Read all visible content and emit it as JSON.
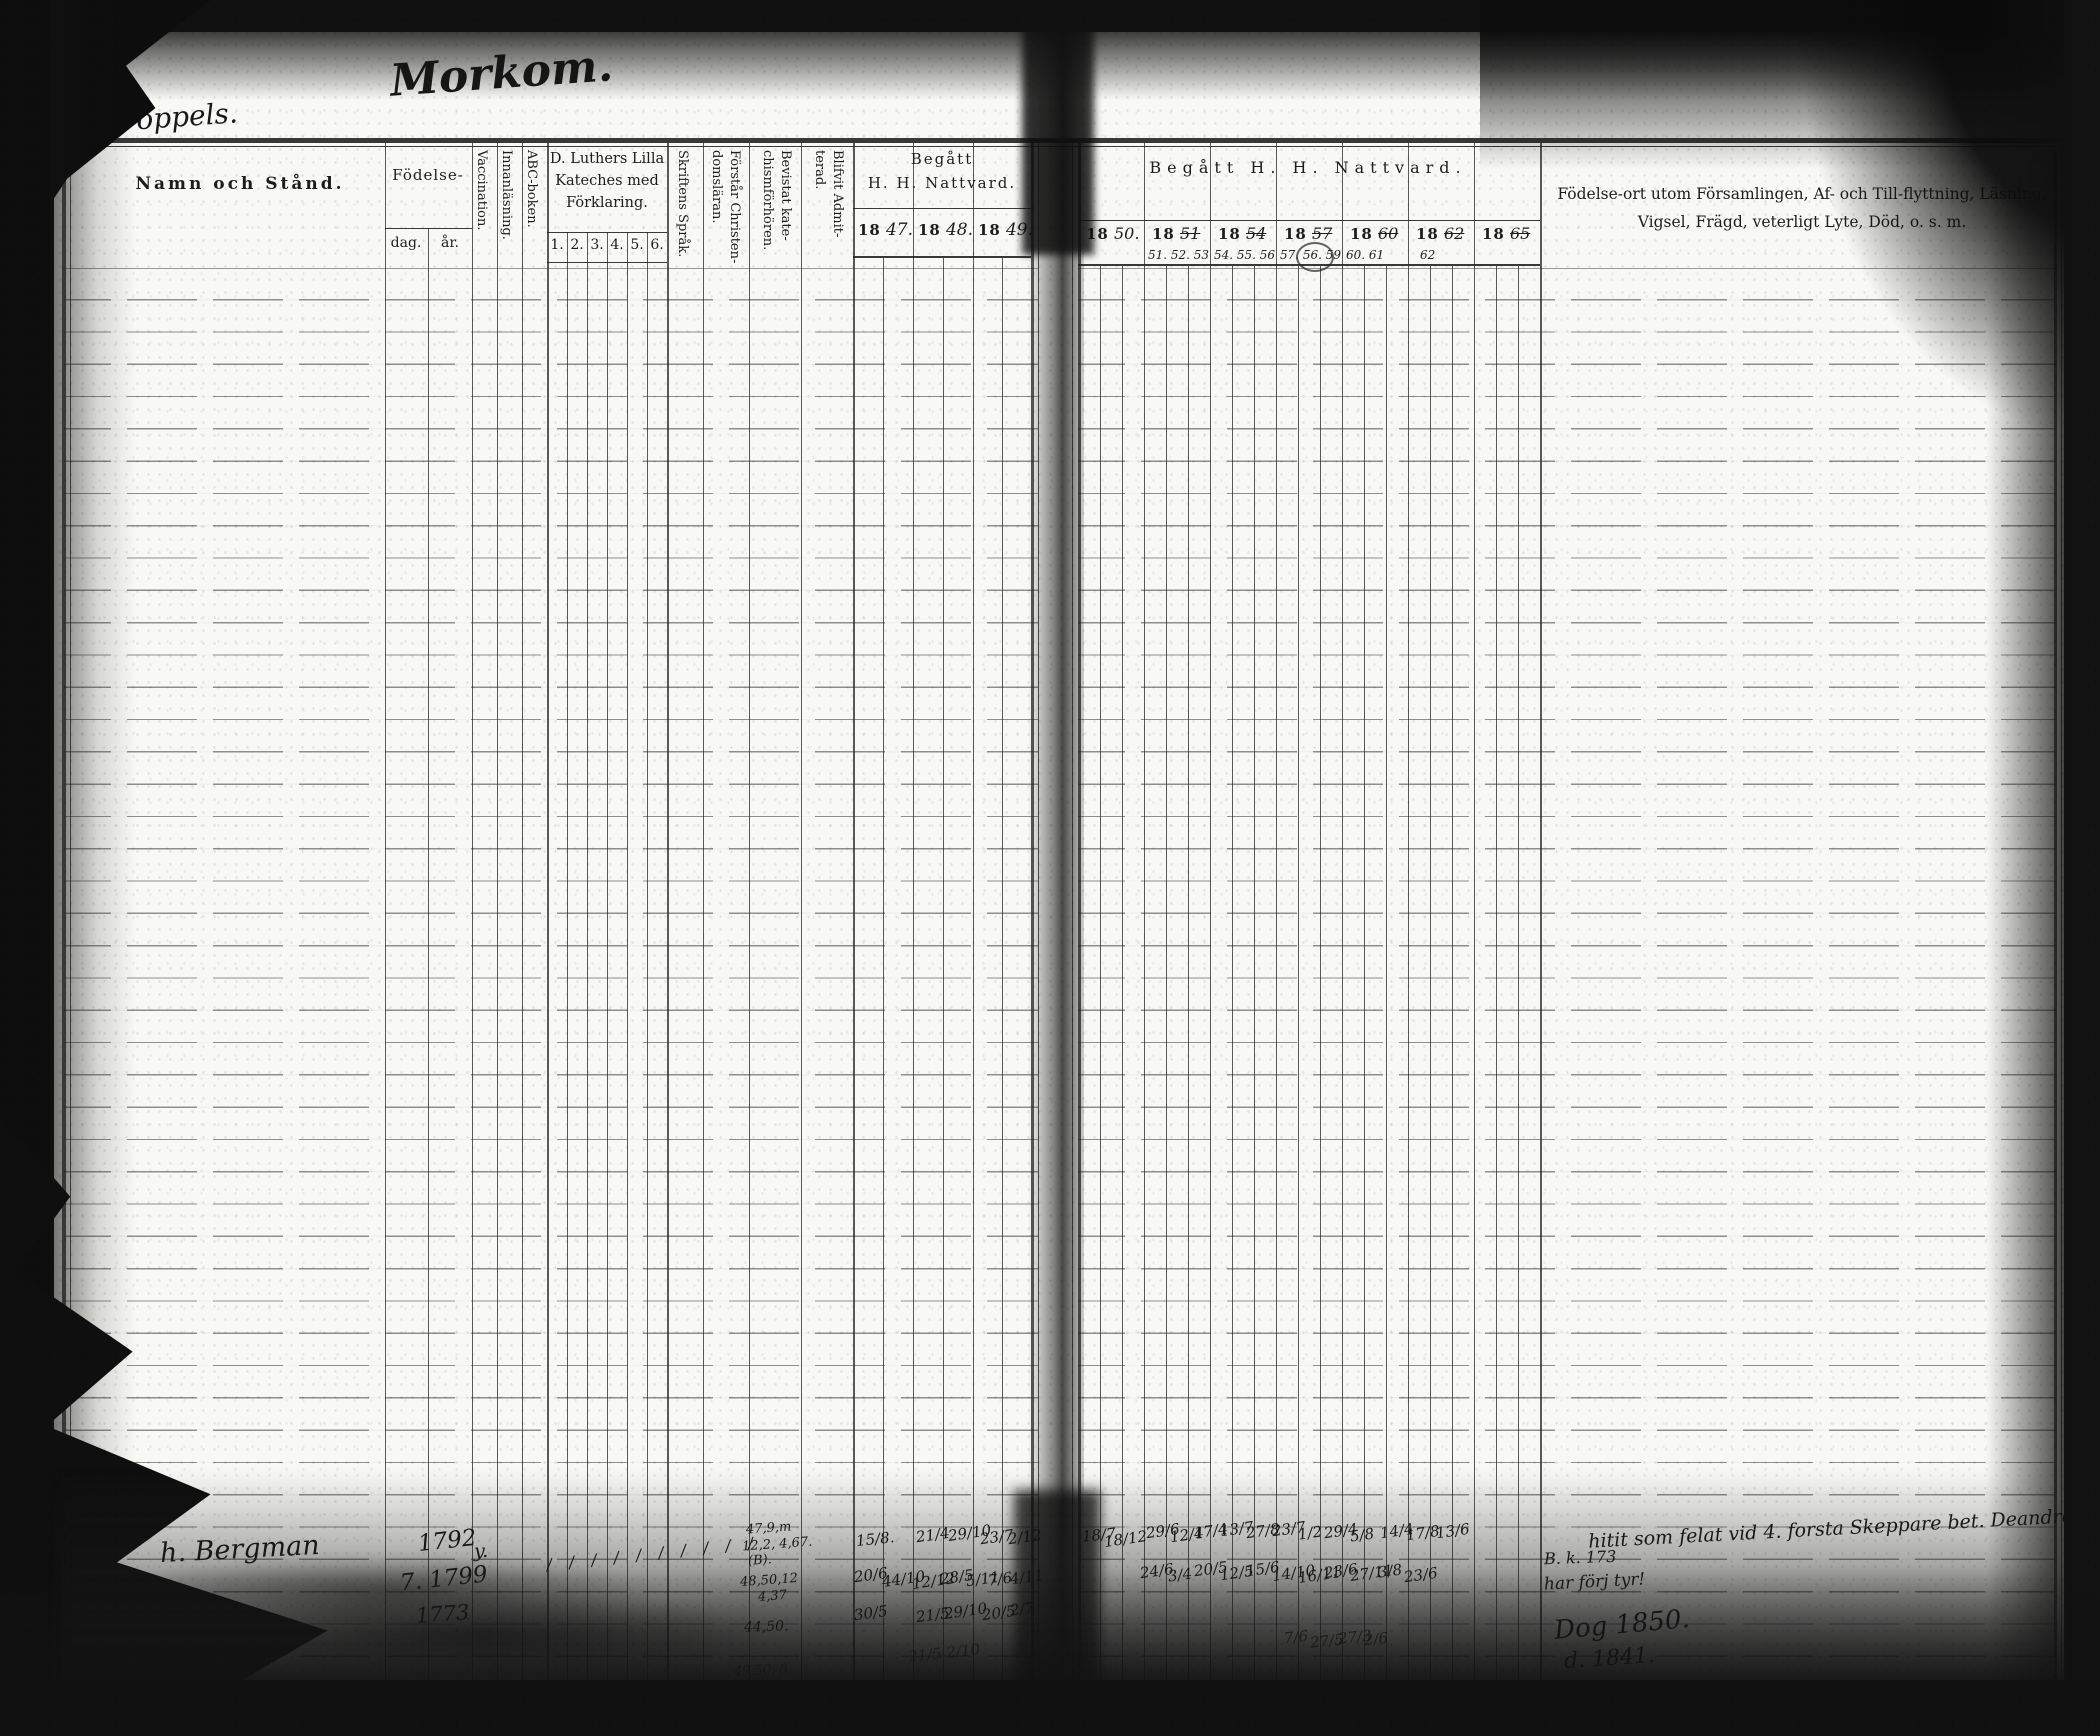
{
  "scan": {
    "description": "Scanned two-page spread of a 19th-century Swedish parish communion ledger"
  },
  "left_page": {
    "name_header": "Namn och Stånd.",
    "birth_label": "Födelse-",
    "birth_day": "dag.",
    "birth_year": "år.",
    "col_vaccination": "Vaccination.",
    "col_reading": "Innanläsning.",
    "col_abc": "ABC-boken.",
    "catechism_line1": "D. Luthers Lilla",
    "catechism_line2": "Kateches med",
    "catechism_line3": "Förklaring.",
    "catechism_numbers": [
      "1.",
      "2.",
      "3.",
      "4.",
      "5.",
      "6."
    ],
    "col_scripture": "Skriftens Språk.",
    "col_understands_1": "Förstår Christen-",
    "col_understands_2": "domsläran.",
    "col_attended_1": "Bevistat kate-",
    "col_attended_2": "chismförhören.",
    "col_admitted_1": "Blifvit Admit-",
    "col_admitted_2": "terad.",
    "communion_line1": "Begått",
    "communion_line2": "H. H. Nattvard.",
    "years": [
      {
        "printed": "18",
        "hand": "47."
      },
      {
        "printed": "18",
        "hand": "48."
      },
      {
        "printed": "18",
        "hand": "49."
      }
    ]
  },
  "right_page": {
    "communion_label": "Begått  H.  H.  Nattvard.",
    "years": [
      {
        "printed": "18",
        "hand": "50.",
        "list": ""
      },
      {
        "printed": "18",
        "hand": "51",
        "list": "51. 52. 53"
      },
      {
        "printed": "18",
        "hand": "54",
        "list": "54. 55. 56"
      },
      {
        "printed": "18",
        "hand": "57",
        "list": "57. 56. 59"
      },
      {
        "printed": "18",
        "hand": "60",
        "list": "60. 61"
      },
      {
        "printed": "18",
        "hand": "62",
        "list": "62"
      },
      {
        "printed": "18",
        "hand": "65",
        "list": ""
      }
    ],
    "notes_line1": "Födelse-ort utom Församlingen, Af- och Till-flyttning, Läsning,",
    "notes_line2": "Vigsel, Frägd, veterligt Lyte, Död, o. s. m."
  },
  "handwriting": {
    "marks": [
      "268.",
      "Morkom.",
      "Kroppels.",
      "h. Bergman",
      "1792",
      "7. 1799",
      "1773",
      "y.",
      "/ / / / / / / / / /",
      "47,9,m",
      "12,2, 4,67.",
      "(B).",
      "48,50,12",
      "4,37",
      "44,50.",
      "49,50, 8.",
      "15/8.",
      "21/4",
      "29/10",
      "23/7",
      "2/12",
      "20/6",
      "44/10",
      "12/12",
      "28/5",
      "5/11",
      "7/6",
      "4/11",
      "30/5",
      "21/5",
      "29/10",
      "20/5",
      "2/7",
      "21/5  2/10",
      "18/7",
      "18/12",
      "29/6",
      "12/4",
      "17/4",
      "13/7",
      "27/8",
      "23/7",
      "1/2",
      "29/4",
      "5/8",
      "14/4",
      "17/8",
      "13/6",
      "24/6",
      "3/4",
      "20/5",
      "12/5",
      "15/6",
      "14/10",
      "16/11",
      "23/6",
      "27/11",
      "3/8",
      "23/6",
      "7/6",
      "27/5",
      "27/3",
      "2/6",
      "hitit som felat vid 4. forsta Skeppare bet. Deandre",
      "B. k. 173",
      "har förj tyr!",
      "Dog 1850.",
      "d. 1841."
    ]
  }
}
